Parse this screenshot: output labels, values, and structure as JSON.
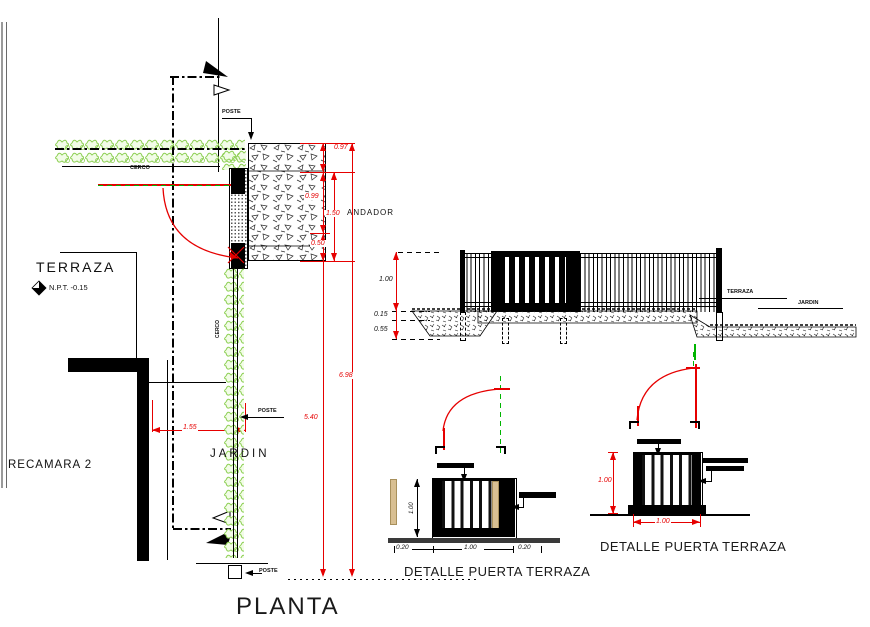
{
  "drawing": {
    "sheet_title": "PLANTA"
  },
  "plan": {
    "title": "PLANTA",
    "terraza_label": "TERRAZA",
    "npt_label": "N.P.T. -0.15",
    "recamara_label": "RECAMARA 2",
    "jardin_label": "JARDIN",
    "andador_label": "ANDADOR",
    "cerco_label": "CERCO",
    "cerco_vertical_label": "CERCO",
    "poste_top_label": "POSTE",
    "poste_mid_label": "POSTE",
    "poste_bottom_label": "POSTE",
    "dims": {
      "d097": "0.97",
      "d099": "0.99",
      "d150": "1.50",
      "d050": "0.50",
      "d155": "1.55",
      "d540": "5.40",
      "d698": "6.98"
    }
  },
  "elevation": {
    "dims": {
      "height": "1.00",
      "step": "0.15",
      "footing": "0.55"
    },
    "terraza_label": "TERRAZA",
    "jardin_label": "JARDIN"
  },
  "detail_left": {
    "title": "DETALLE PUERTA TERRAZA",
    "dims": {
      "height": "1.00",
      "left": "0.20",
      "width": "1.00",
      "right": "0.20"
    }
  },
  "detail_right": {
    "title": "DETALLE PUERTA TERRAZA",
    "dims": {
      "height": "1.00",
      "width": "1.00"
    }
  },
  "icons": {
    "section_marker": "filled-flag-with-hollow-triangle",
    "level_marker": "half-filled-diamond",
    "leader_arrow": "solid-triangle",
    "door_swing": "quarter-arc"
  },
  "colors": {
    "line": "#000000",
    "dimension_red": "#e60000",
    "hedge_green": "#8ccf52",
    "centerline_green": "#00b400",
    "wood_tan": "#d8bf92"
  }
}
